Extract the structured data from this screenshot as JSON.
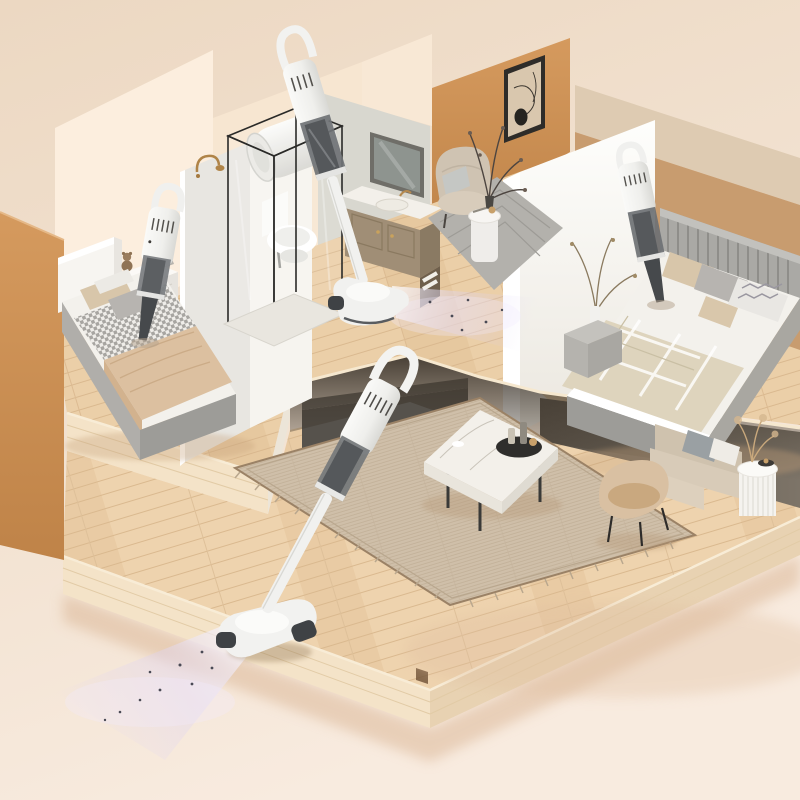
{
  "meta": {
    "title": "Isometric cutaway 3D room scene: two bedrooms, bathroom and sunken living room with four white cordless stick/handheld vacuum cleaners cleaning beds and wooden floors",
    "style": "dollhouse cutaway product render, warm beige tones, no visible text"
  },
  "palette": {
    "bg_top": "#ecd8c2",
    "bg_bottom": "#f8ebdf",
    "wall_cream": "#fceede",
    "wall_cream_deep": "#f7e6d1",
    "wall_gray_green": "#d8d7cf",
    "wall_orange": "#cf9257",
    "wall_orange_deep": "#bf8348",
    "wall_tan_light": "#decbb2",
    "wall_tan": "#c89c6f",
    "wall_white": "#fdfdfb",
    "wood_base": "#ebcfa8",
    "wood_line": "#d8b68c",
    "wood_lower": "#eed3ae",
    "wood_edge_light": "#f4e3c8",
    "underside_dark": "#3e362c",
    "charcoal_console": "#56524c",
    "under_wall": "#6f665b",
    "rug_beige": "#cfbfa9",
    "rug_border": "#9b8266",
    "rug_gray": "#b3b1ac",
    "bed_linen": "#f3f1ec",
    "blanket_tan": "#dcc0a0",
    "blanket_plaid": "#ded4bd",
    "bed_frame_gray": "#9d9c98",
    "pillow_beige": "#d8c6aa",
    "pillow_gray": "#b7b4b0",
    "marble_white": "#f3f0ea",
    "sofa_beige": "#d8cbb8",
    "chair_shell": "#d9c0a2",
    "table_fluted_white": "#f5f3ef",
    "vacuum_white": "#f4f4f2",
    "vacuum_cup_gray": "#75787b",
    "vacuum_nozzle_dark": "#46494c",
    "beam_lavender": "#ddd3f5",
    "gold": "#b08448",
    "frame_black": "#2e2c29",
    "art_paper": "#d9c7ae",
    "mirror_green": "#8e948f",
    "heater_white": "#f6f6f3"
  },
  "objects": {
    "vacuum_count": 4,
    "left_bedroom": [
      "white headboard bed with checkered throw and tan blanket",
      "white nightstand with teddy bear and books",
      "handheld vacuum cleaning mattress"
    ],
    "bathroom": [
      "glass shower enclosure",
      "white toilet",
      "wall water heater",
      "gold shower faucet",
      "taupe vanity with marble top, mirror and towels",
      "standing stick vacuum with lit floor head"
    ],
    "lounge_nook": [
      "ochre accent wall with framed line art",
      "beige armchair",
      "white pedestal side table",
      "vase with dark branches",
      "gray patterned rug"
    ],
    "right_bedroom": [
      "gray slatted headboard bed with plaid blanket and chevron pillow",
      "gray nightstand with branch vase",
      "handheld vacuum cleaning mattress"
    ],
    "living_room": [
      "woven beige area rug",
      "marble coffee table with black tray and bottles",
      "beige sofa with gray cushion",
      "beige shell accent chair",
      "white fluted side table with pampas and bowl",
      "stick vacuum with glowing headlight beam and dust particles"
    ]
  }
}
